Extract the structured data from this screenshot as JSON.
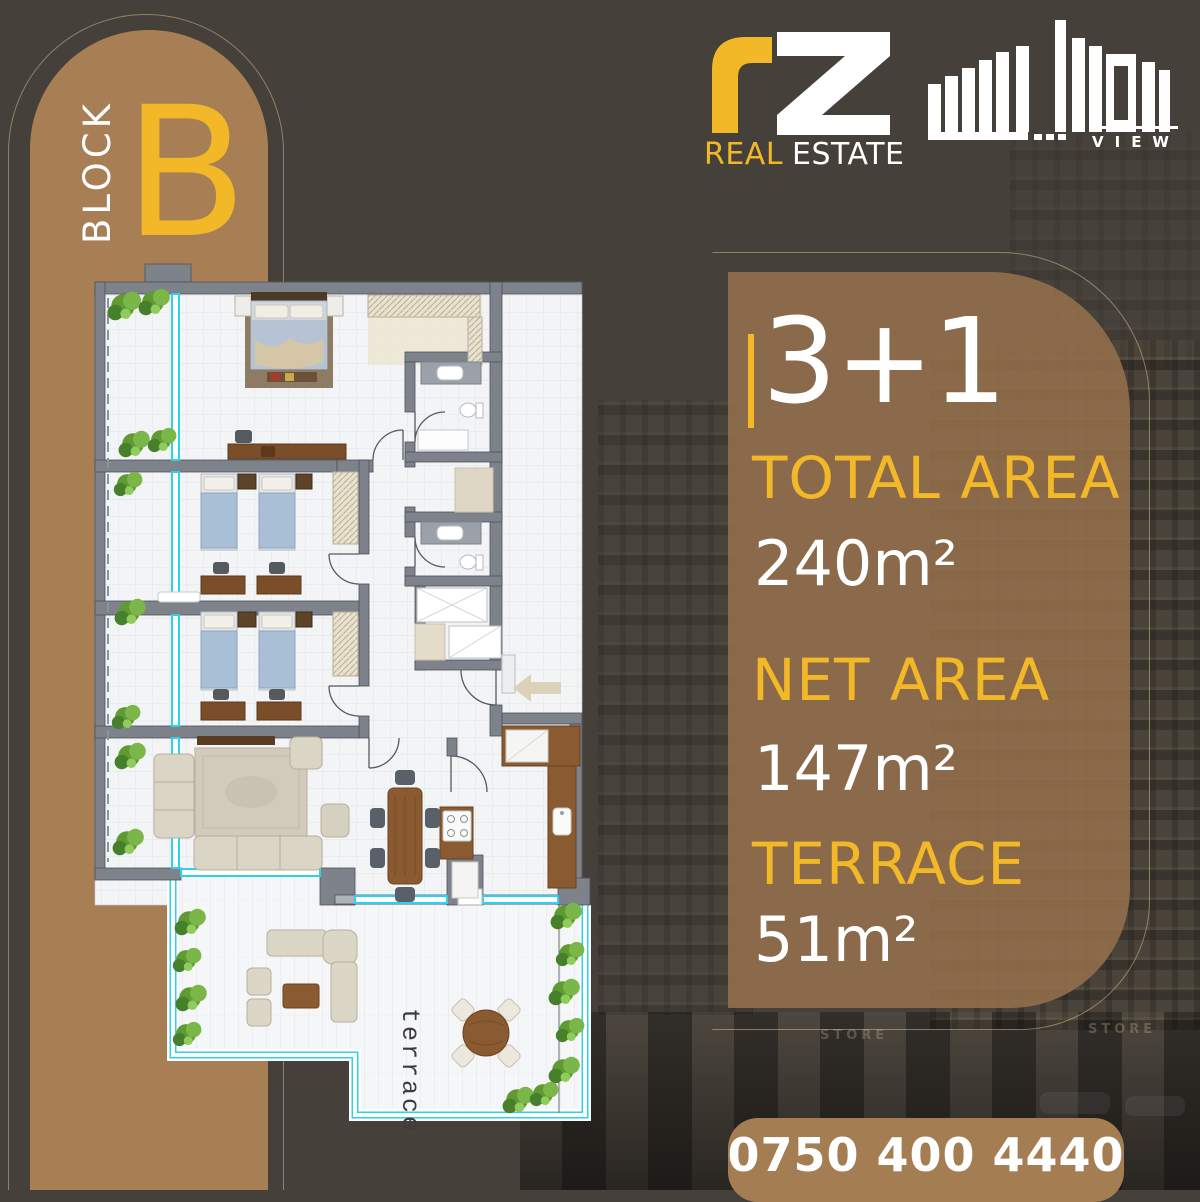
{
  "background": {
    "store_sign": "STORE"
  },
  "block_badge": {
    "label": "BLOCK",
    "letter": "B"
  },
  "logo_rz": {
    "brand_letters": "rz",
    "real": "REAL",
    "estate": "ESTATE"
  },
  "logo_majidi": {
    "brand_stylized": "MAJIDI",
    "view": "VIEW"
  },
  "info_panel": {
    "unit_type": "3+1",
    "total_area_label": "TOTAL AREA",
    "total_area_value": "240m²",
    "net_area_label": "NET AREA",
    "net_area_value": "147m²",
    "terrace_label": "TERRACE",
    "terrace_value": "51m²"
  },
  "contact": {
    "phone": "0750 400 4440"
  },
  "floor_plan": {
    "terrace_text": "terrace"
  },
  "colors": {
    "accent_yellow": "#f2b828",
    "column_tan": "#a87f55",
    "panel_brown": "#8f6c4c",
    "pill_tan": "#a57d53",
    "background_dark": "#45403a",
    "window_cyan": "#2fd0ea"
  }
}
